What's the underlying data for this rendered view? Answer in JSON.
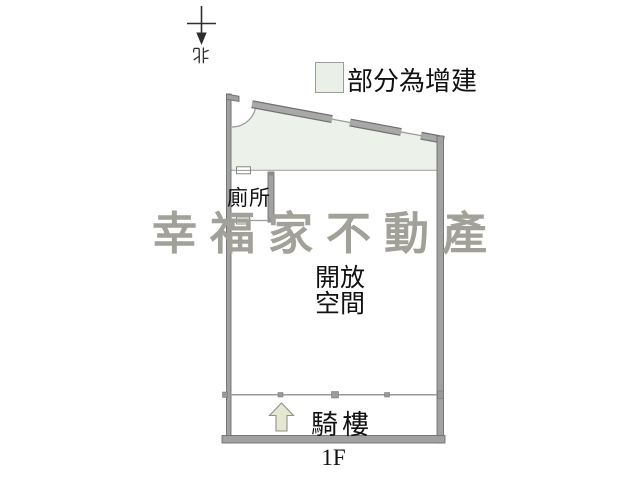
{
  "colors": {
    "wall_fill": "#a1a1a1",
    "wall_edge": "#6f6f6f",
    "addition_fill": "#ecf2e9",
    "legend_swatch_fill": "#eaf0e7",
    "arrow_fill": "#e5e7d0",
    "watermark_color": "#a1a199",
    "line_color": "#9a9a9a",
    "text_color": "#111111"
  },
  "north": {
    "label": "北"
  },
  "legend": {
    "label": "部分為增建"
  },
  "rooms": {
    "toilet": {
      "label": "廁所"
    },
    "open_space": {
      "line1": "開放",
      "line2": "空間"
    }
  },
  "arcade": {
    "label": "騎樓"
  },
  "floor": {
    "label": "1F"
  },
  "watermark": {
    "text": "幸福家不動產"
  }
}
